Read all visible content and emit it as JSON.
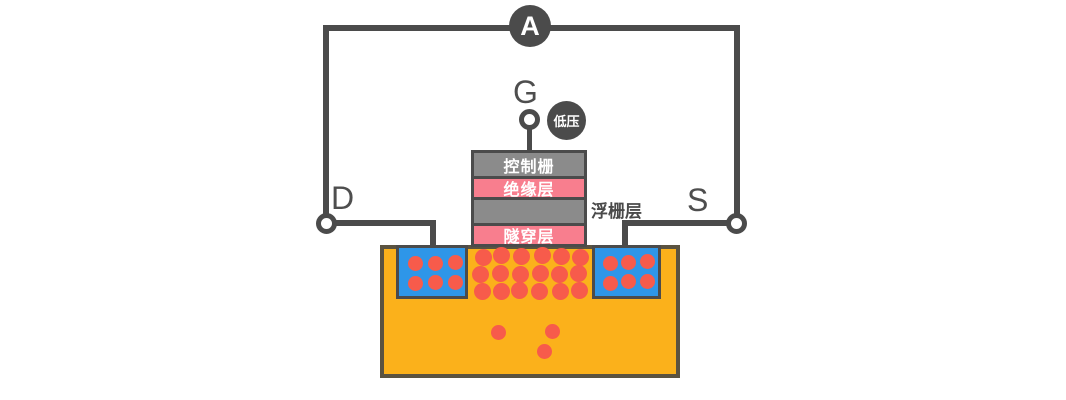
{
  "diagram": {
    "ammeter_label": "A",
    "terminals": {
      "gate": "G",
      "drain": "D",
      "source": "S"
    },
    "voltage_badge": "低压",
    "layers": {
      "control_gate": "控制栅",
      "insulation": "绝缘层",
      "floating_gate_side_label": "浮栅层",
      "tunnel": "隧穿层"
    }
  },
  "colors": {
    "dark": "#4B4B4B",
    "gray": "#8B8B8B",
    "pink": "#F87E8E",
    "orange": "#FBB11B",
    "blue": "#2E96E8",
    "red": "#F75B4B",
    "sub-border": "#5B5340",
    "text": "#4E4E4E"
  },
  "electrons": {
    "color": "#F75B4B",
    "groups": [
      {
        "name": "drain-region-electron",
        "diameter": 15,
        "centers": [
          [
            415,
            263
          ],
          [
            435,
            263
          ],
          [
            455,
            262
          ],
          [
            415,
            283
          ],
          [
            435,
            282
          ],
          [
            455,
            282
          ]
        ]
      },
      {
        "name": "source-region-electron",
        "diameter": 15,
        "centers": [
          [
            610,
            263
          ],
          [
            628,
            262
          ],
          [
            647,
            261
          ],
          [
            610,
            283
          ],
          [
            628,
            281
          ],
          [
            647,
            281
          ]
        ]
      },
      {
        "name": "channel-electron",
        "diameter": 17,
        "centers": [
          [
            483,
            257
          ],
          [
            501,
            255
          ],
          [
            521,
            256
          ],
          [
            542,
            255
          ],
          [
            561,
            256
          ],
          [
            580,
            257
          ],
          [
            480,
            274
          ],
          [
            500,
            273
          ],
          [
            520,
            274
          ],
          [
            540,
            273
          ],
          [
            559,
            274
          ],
          [
            578,
            273
          ],
          [
            482,
            291
          ],
          [
            501,
            291
          ],
          [
            519,
            290
          ],
          [
            539,
            291
          ],
          [
            560,
            291
          ],
          [
            579,
            290
          ]
        ]
      },
      {
        "name": "substrate-electron",
        "diameter": 15,
        "centers": [
          [
            498,
            332
          ],
          [
            552,
            331
          ],
          [
            544,
            351
          ]
        ]
      }
    ]
  }
}
